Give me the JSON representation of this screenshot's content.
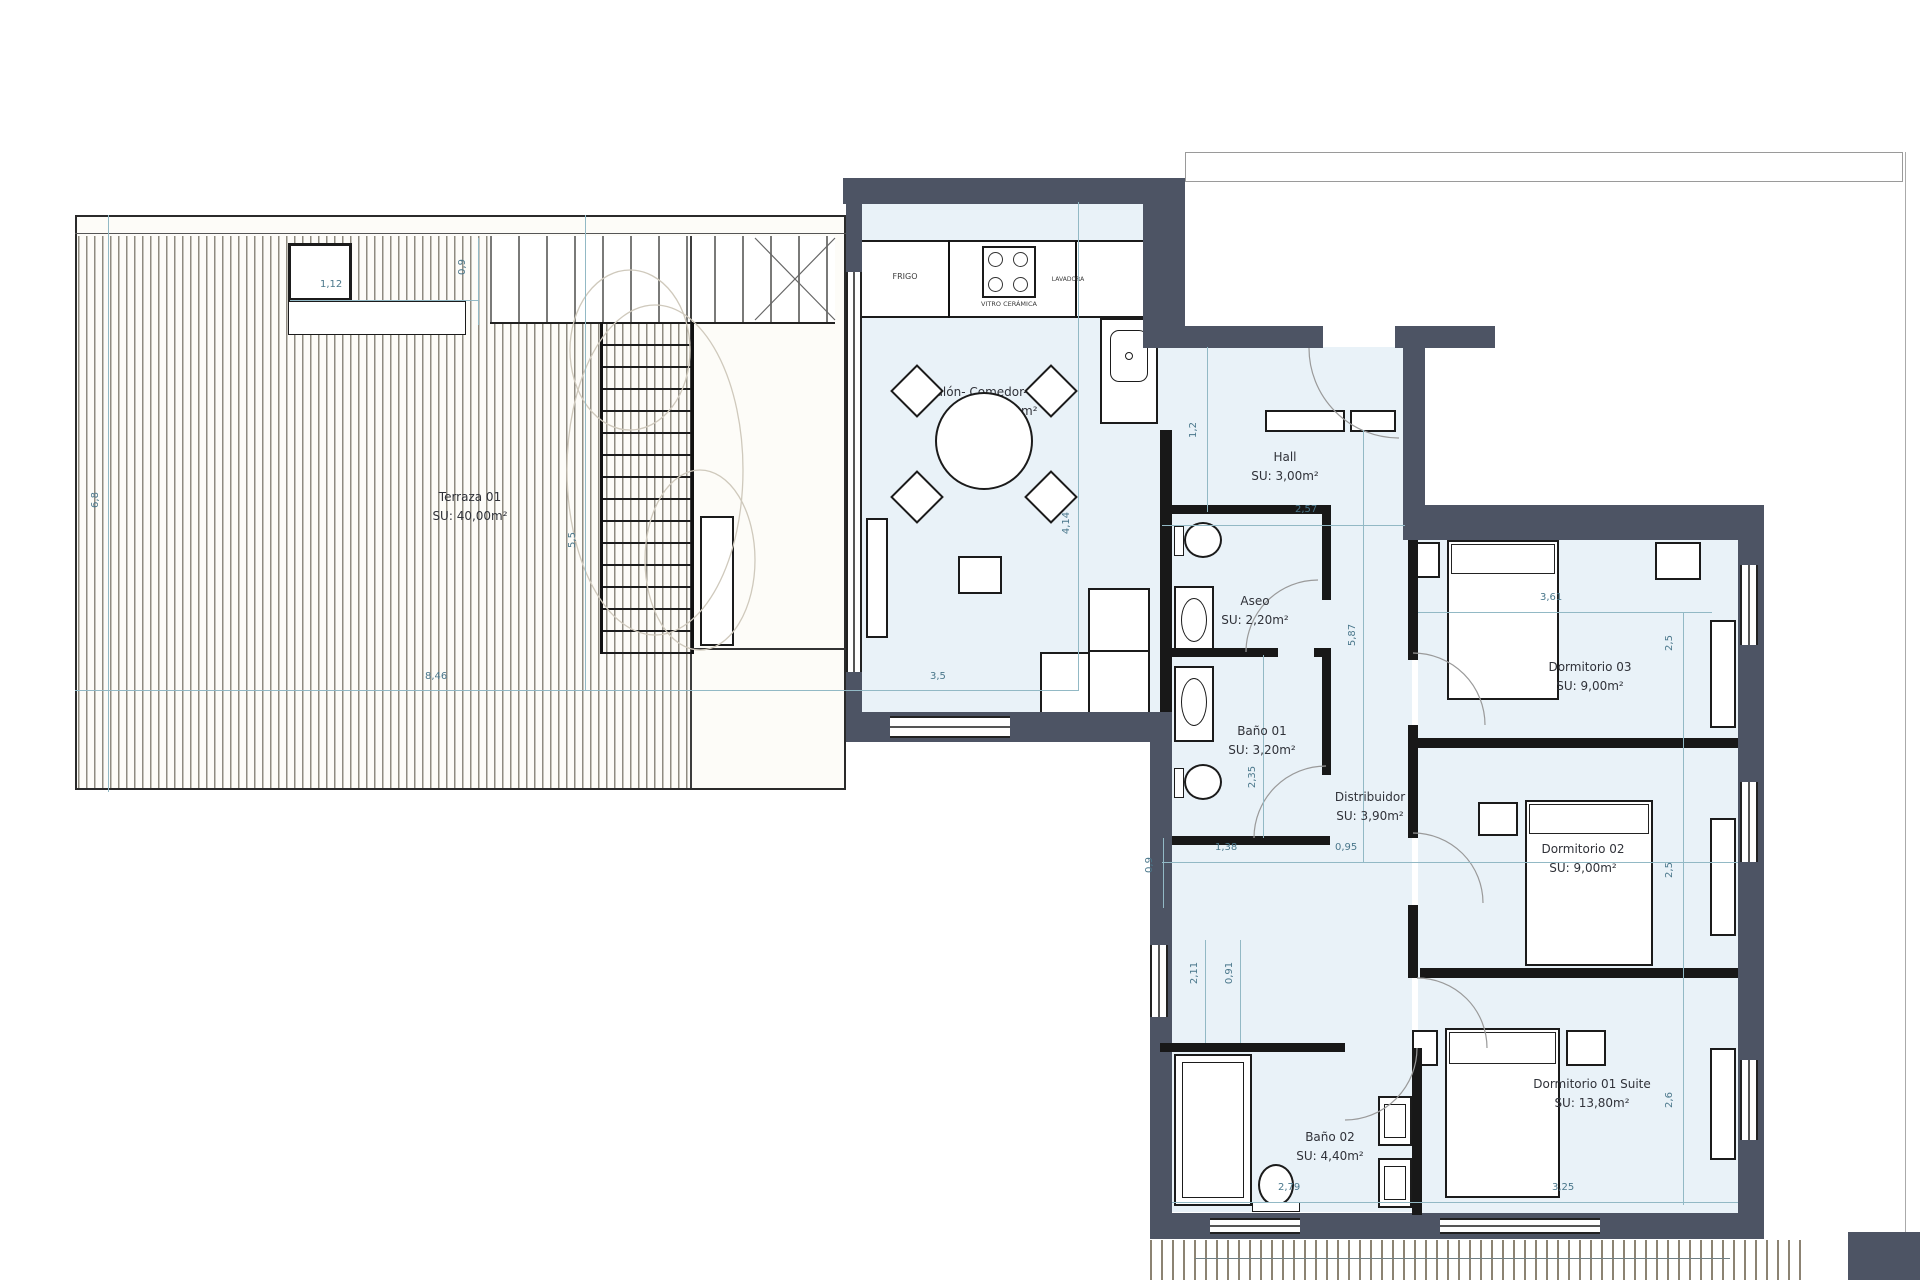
{
  "rooms": [
    {
      "name": "Terraza 01",
      "area": "SU: 40,00m²"
    },
    {
      "name": "Salón- Comedor- Cocina",
      "area": "SU: 21,10m²"
    },
    {
      "name": "Hall",
      "area": "SU: 3,00m²"
    },
    {
      "name": "Aseo",
      "area": "SU: 2,20m²"
    },
    {
      "name": "Baño 01",
      "area": "SU: 3,20m²"
    },
    {
      "name": "Distribuidor",
      "area": "SU: 3,90m²"
    },
    {
      "name": "Dormitorio 03",
      "area": "SU: 9,00m²"
    },
    {
      "name": "Dormitorio 02",
      "area": "SU: 9,00m²"
    },
    {
      "name": "Dormitorio 01 Suite",
      "area": "SU: 13,80m²"
    },
    {
      "name": "Baño 02",
      "area": "SU: 4,40m²"
    }
  ],
  "kitchen_labels": {
    "fridge": "FRIGO",
    "hob": "VITRO CERÁMICA",
    "appliance": "LAVADORA"
  },
  "dimensions": [
    {
      "v": "1,12"
    },
    {
      "v": "0,9"
    },
    {
      "v": "8,46"
    },
    {
      "v": "3,5"
    },
    {
      "v": "6,8"
    },
    {
      "v": "5,5"
    },
    {
      "v": "4,14"
    },
    {
      "v": "1,2"
    },
    {
      "v": "2,57"
    },
    {
      "v": "5,87"
    },
    {
      "v": "2,35"
    },
    {
      "v": "1,38"
    },
    {
      "v": "0,95"
    },
    {
      "v": "0,9"
    },
    {
      "v": "2,11"
    },
    {
      "v": "0,91"
    },
    {
      "v": "3,61"
    },
    {
      "v": "2,5"
    },
    {
      "v": "2,5"
    },
    {
      "v": "2,6"
    },
    {
      "v": "2,79"
    },
    {
      "v": "3,25"
    }
  ],
  "colors": {
    "wall": "#4d5464",
    "partition": "#181818",
    "dimension_text": "#4a778b",
    "dimension_line": "#92b9c5",
    "room_tint": "#e9f2f8",
    "terrace_line": "#8f8b81"
  }
}
